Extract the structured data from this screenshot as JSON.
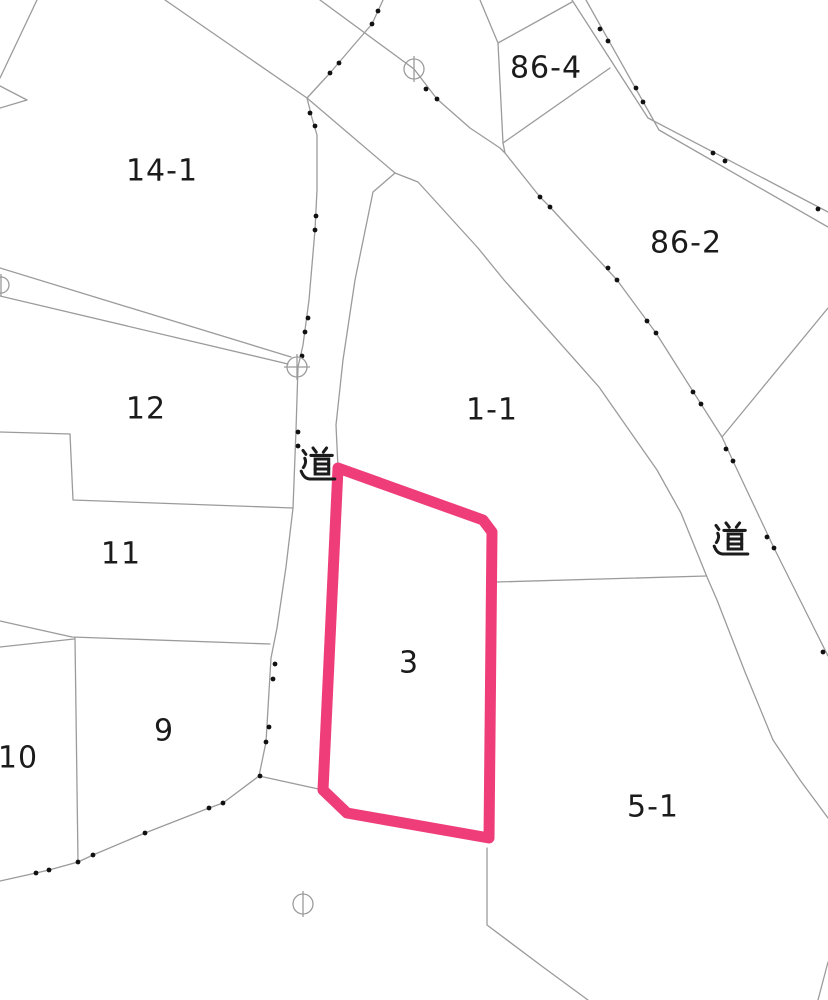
{
  "map": {
    "type": "cadastral-parcel-map",
    "background_color": "#ffffff",
    "boundary_line_color": "#9b9b9b",
    "dot_color": "#111111",
    "label_color": "#1b1b1b",
    "highlight_color": "#ee3d78",
    "highlight_stroke_width": 11,
    "labels": [
      {
        "id": "14-1",
        "text": "14-1",
        "x": 162,
        "y": 171,
        "size": 30
      },
      {
        "id": "86-4",
        "text": "86-4",
        "x": 546,
        "y": 68,
        "size": 30
      },
      {
        "id": "86-2",
        "text": "86-2",
        "x": 686,
        "y": 243,
        "size": 30
      },
      {
        "id": "12",
        "text": "12",
        "x": 146,
        "y": 409,
        "size": 30
      },
      {
        "id": "1-1",
        "text": "1-1",
        "x": 492,
        "y": 410,
        "size": 30
      },
      {
        "id": "road-west",
        "text": "道",
        "x": 318,
        "y": 464,
        "size": 34,
        "kanji": true
      },
      {
        "id": "road-east",
        "text": "道",
        "x": 731,
        "y": 539,
        "size": 34,
        "kanji": true
      },
      {
        "id": "11",
        "text": "11",
        "x": 121,
        "y": 554,
        "size": 30
      },
      {
        "id": "3",
        "text": "3",
        "x": 409,
        "y": 663,
        "size": 30
      },
      {
        "id": "9",
        "text": "9",
        "x": 164,
        "y": 731,
        "size": 30
      },
      {
        "id": "10",
        "text": "10",
        "x": 18,
        "y": 758,
        "size": 30
      },
      {
        "id": "5-1",
        "text": "5-1",
        "x": 653,
        "y": 807,
        "size": 30
      }
    ],
    "highlight_parcel": {
      "label": "3",
      "points": [
        [
          338,
          468
        ],
        [
          483,
          520
        ],
        [
          492,
          532
        ],
        [
          489,
          838
        ],
        [
          347,
          813
        ],
        [
          323,
          790
        ]
      ]
    },
    "boundary_lines": [
      {
        "id": "parcel-14-1-west",
        "points": [
          [
            37,
            0
          ],
          [
            0,
            78
          ]
        ]
      },
      {
        "id": "west-edge-wedge-upper",
        "points": [
          [
            0,
            86
          ],
          [
            27,
            100
          ]
        ]
      },
      {
        "id": "west-edge-wedge-lower",
        "points": [
          [
            0,
            108
          ],
          [
            27,
            100
          ]
        ]
      },
      {
        "id": "road-northwest-edge",
        "points": [
          [
            165,
            0
          ],
          [
            307,
            98
          ],
          [
            395,
            173
          ]
        ]
      },
      {
        "id": "road-east-west-edge",
        "points": [
          [
            395,
            173
          ],
          [
            418,
            182
          ],
          [
            478,
            248
          ],
          [
            504,
            280
          ],
          [
            599,
            387
          ],
          [
            657,
            470
          ],
          [
            681,
            513
          ],
          [
            707,
            577
          ],
          [
            717,
            600
          ],
          [
            745,
            672
          ],
          [
            773,
            740
          ],
          [
            800,
            780
          ],
          [
            828,
            818
          ]
        ]
      },
      {
        "id": "road-west-east-edge",
        "points": [
          [
            395,
            173
          ],
          [
            373,
            192
          ],
          [
            355,
            280
          ],
          [
            343,
            360
          ],
          [
            336,
            425
          ],
          [
            338,
            468
          ]
        ]
      },
      {
        "id": "strip-road-upper",
        "points": [
          [
            0,
            268
          ],
          [
            291,
            357
          ]
        ]
      },
      {
        "id": "strip-road-lower",
        "points": [
          [
            0,
            296
          ],
          [
            288,
            364
          ]
        ]
      },
      {
        "id": "boundary-12-11",
        "points": [
          [
            0,
            432
          ],
          [
            70,
            434
          ],
          [
            73,
            500
          ],
          [
            293,
            508
          ]
        ]
      },
      {
        "id": "boundary-11-9",
        "points": [
          [
            0,
            621
          ],
          [
            72,
            637
          ],
          [
            270,
            644
          ]
        ]
      },
      {
        "id": "boundary-10-north",
        "points": [
          [
            0,
            647
          ],
          [
            74,
            639
          ]
        ]
      },
      {
        "id": "boundary-10-9",
        "points": [
          [
            75,
            638
          ],
          [
            78,
            862
          ]
        ]
      },
      {
        "id": "dotted-boundary-west-road",
        "points": [
          [
            383,
            0
          ],
          [
            372,
            24
          ],
          [
            353,
            46
          ],
          [
            330,
            73
          ],
          [
            307,
            98
          ],
          [
            312,
            118
          ],
          [
            317,
            135
          ],
          [
            317,
            190
          ],
          [
            315,
            230
          ],
          [
            309,
            300
          ],
          [
            303,
            345
          ],
          [
            298,
            367
          ],
          [
            296,
            430
          ],
          [
            293,
            508
          ],
          [
            286,
            567
          ],
          [
            277,
            628
          ],
          [
            271,
            658
          ],
          [
            266,
            742
          ],
          [
            259,
            776
          ]
        ]
      },
      {
        "id": "dotted-boundary-southwest",
        "points": [
          [
            259,
            776
          ],
          [
            223,
            803
          ],
          [
            209,
            808
          ],
          [
            145,
            833
          ],
          [
            93,
            855
          ],
          [
            78,
            862
          ],
          [
            49,
            870
          ],
          [
            36,
            873
          ],
          [
            0,
            881
          ]
        ]
      },
      {
        "id": "connector-9-to-parcel-3",
        "points": [
          [
            259,
            776
          ],
          [
            323,
            790
          ]
        ]
      },
      {
        "id": "dotted-boundary-east-road",
        "points": [
          [
            320,
            0
          ],
          [
            414,
            69
          ],
          [
            437,
            99
          ],
          [
            470,
            128
          ],
          [
            500,
            148
          ],
          [
            505,
            153
          ],
          [
            540,
            197
          ],
          [
            550,
            207
          ],
          [
            617,
            280
          ],
          [
            656,
            333
          ],
          [
            701,
            404
          ],
          [
            722,
            437
          ],
          [
            733,
            461
          ],
          [
            774,
            548
          ],
          [
            828,
            656
          ]
        ]
      },
      {
        "id": "parcel-86-4-west",
        "points": [
          [
            480,
            0
          ],
          [
            498,
            43
          ],
          [
            503,
            143
          ],
          [
            505,
            153
          ]
        ]
      },
      {
        "id": "parcel-86-4-north",
        "points": [
          [
            498,
            43
          ],
          [
            572,
            2
          ]
        ]
      },
      {
        "id": "parcel-86-4-south",
        "points": [
          [
            503,
            143
          ],
          [
            610,
            68
          ]
        ]
      },
      {
        "id": "road-band-north-edge",
        "points": [
          [
            572,
            0
          ],
          [
            648,
            118
          ],
          [
            828,
            212
          ]
        ]
      },
      {
        "id": "road-band-south-edge",
        "points": [
          [
            586,
            0
          ],
          [
            659,
            130
          ],
          [
            828,
            227
          ]
        ]
      },
      {
        "id": "boundary-86-2-east",
        "points": [
          [
            722,
            437
          ],
          [
            828,
            308
          ]
        ]
      },
      {
        "id": "boundary-1-1-5-1",
        "points": [
          [
            497,
            582
          ],
          [
            706,
            576
          ]
        ]
      },
      {
        "id": "boundary-5-1-west",
        "points": [
          [
            487,
            848
          ],
          [
            487,
            925
          ],
          [
            543,
            967
          ],
          [
            588,
            1000
          ]
        ]
      },
      {
        "id": "corner-line-bottom-right",
        "points": [
          [
            828,
            962
          ],
          [
            818,
            1000
          ]
        ]
      }
    ],
    "boundary_point_dots": [
      [
        378,
        11
      ],
      [
        372,
        24
      ],
      [
        339,
        63
      ],
      [
        330,
        73
      ],
      [
        310,
        113
      ],
      [
        315,
        126
      ],
      [
        316,
        216
      ],
      [
        315,
        230
      ],
      [
        308,
        318
      ],
      [
        305,
        332
      ],
      [
        302,
        356
      ],
      [
        298,
        432
      ],
      [
        298,
        446
      ],
      [
        275,
        664
      ],
      [
        273,
        679
      ],
      [
        269,
        727
      ],
      [
        266,
        742
      ],
      [
        260,
        776
      ],
      [
        223,
        803
      ],
      [
        209,
        808
      ],
      [
        145,
        833
      ],
      [
        93,
        855
      ],
      [
        78,
        862
      ],
      [
        49,
        870
      ],
      [
        36,
        873
      ],
      [
        426,
        89
      ],
      [
        437,
        99
      ],
      [
        540,
        197
      ],
      [
        550,
        207
      ],
      [
        608,
        268
      ],
      [
        617,
        280
      ],
      [
        647,
        321
      ],
      [
        656,
        333
      ],
      [
        693,
        392
      ],
      [
        701,
        404
      ],
      [
        726,
        449
      ],
      [
        733,
        461
      ],
      [
        767,
        537
      ],
      [
        774,
        548
      ],
      [
        823,
        652
      ],
      [
        600,
        29
      ],
      [
        608,
        41
      ],
      [
        636,
        88
      ],
      [
        643,
        102
      ],
      [
        713,
        153
      ],
      [
        725,
        161
      ],
      [
        818,
        209
      ]
    ],
    "survey_markers": [
      {
        "x": 414,
        "y": 69,
        "r": 10,
        "type": "vertical"
      },
      {
        "x": 297,
        "y": 367,
        "r": 10,
        "type": "cross"
      },
      {
        "x": 303,
        "y": 904,
        "r": 10,
        "type": "vertical"
      },
      {
        "x": 1,
        "y": 285,
        "r": 8,
        "type": "vertical"
      }
    ]
  }
}
